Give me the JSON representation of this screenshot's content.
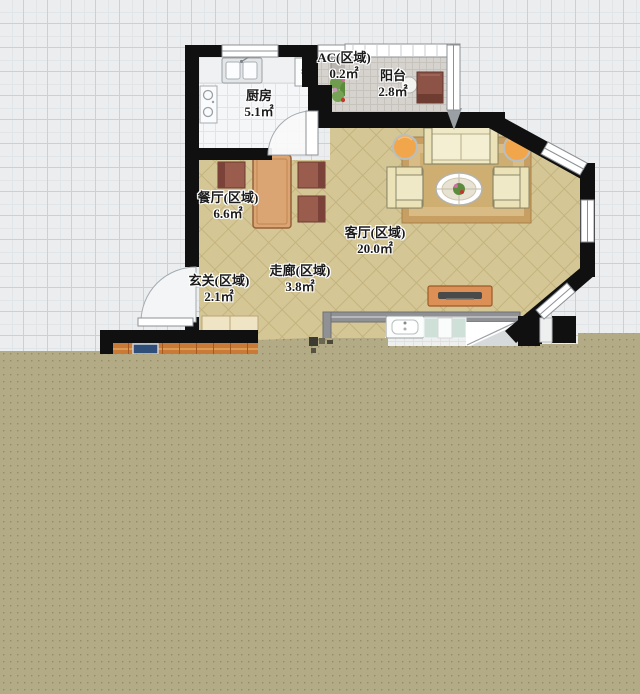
{
  "floorplan": {
    "rooms": [
      {
        "id": "ac-zone",
        "label": "AC(区域)",
        "area": "0.2㎡"
      },
      {
        "id": "balcony",
        "label": "阳台",
        "area": "2.8㎡"
      },
      {
        "id": "kitchen",
        "label": "厨房",
        "area": "5.1㎡"
      },
      {
        "id": "dining",
        "label": "餐厅(区域)",
        "area": "6.6㎡"
      },
      {
        "id": "living",
        "label": "客厅(区域)",
        "area": "20.0㎡"
      },
      {
        "id": "entry",
        "label": "玄关(区域)",
        "area": "2.1㎡"
      },
      {
        "id": "corridor",
        "label": "走廊(区域)",
        "area": "3.8㎡"
      }
    ],
    "colors": {
      "wall": "#101010",
      "tile_floor": "#d5c795",
      "kitchen_floor": "#f5f6f7",
      "balcony_floor": "#d6d3cf",
      "wood_floor": "#c97a36",
      "overlay": "#b3ab86",
      "grid_background": "#ebedee"
    }
  }
}
